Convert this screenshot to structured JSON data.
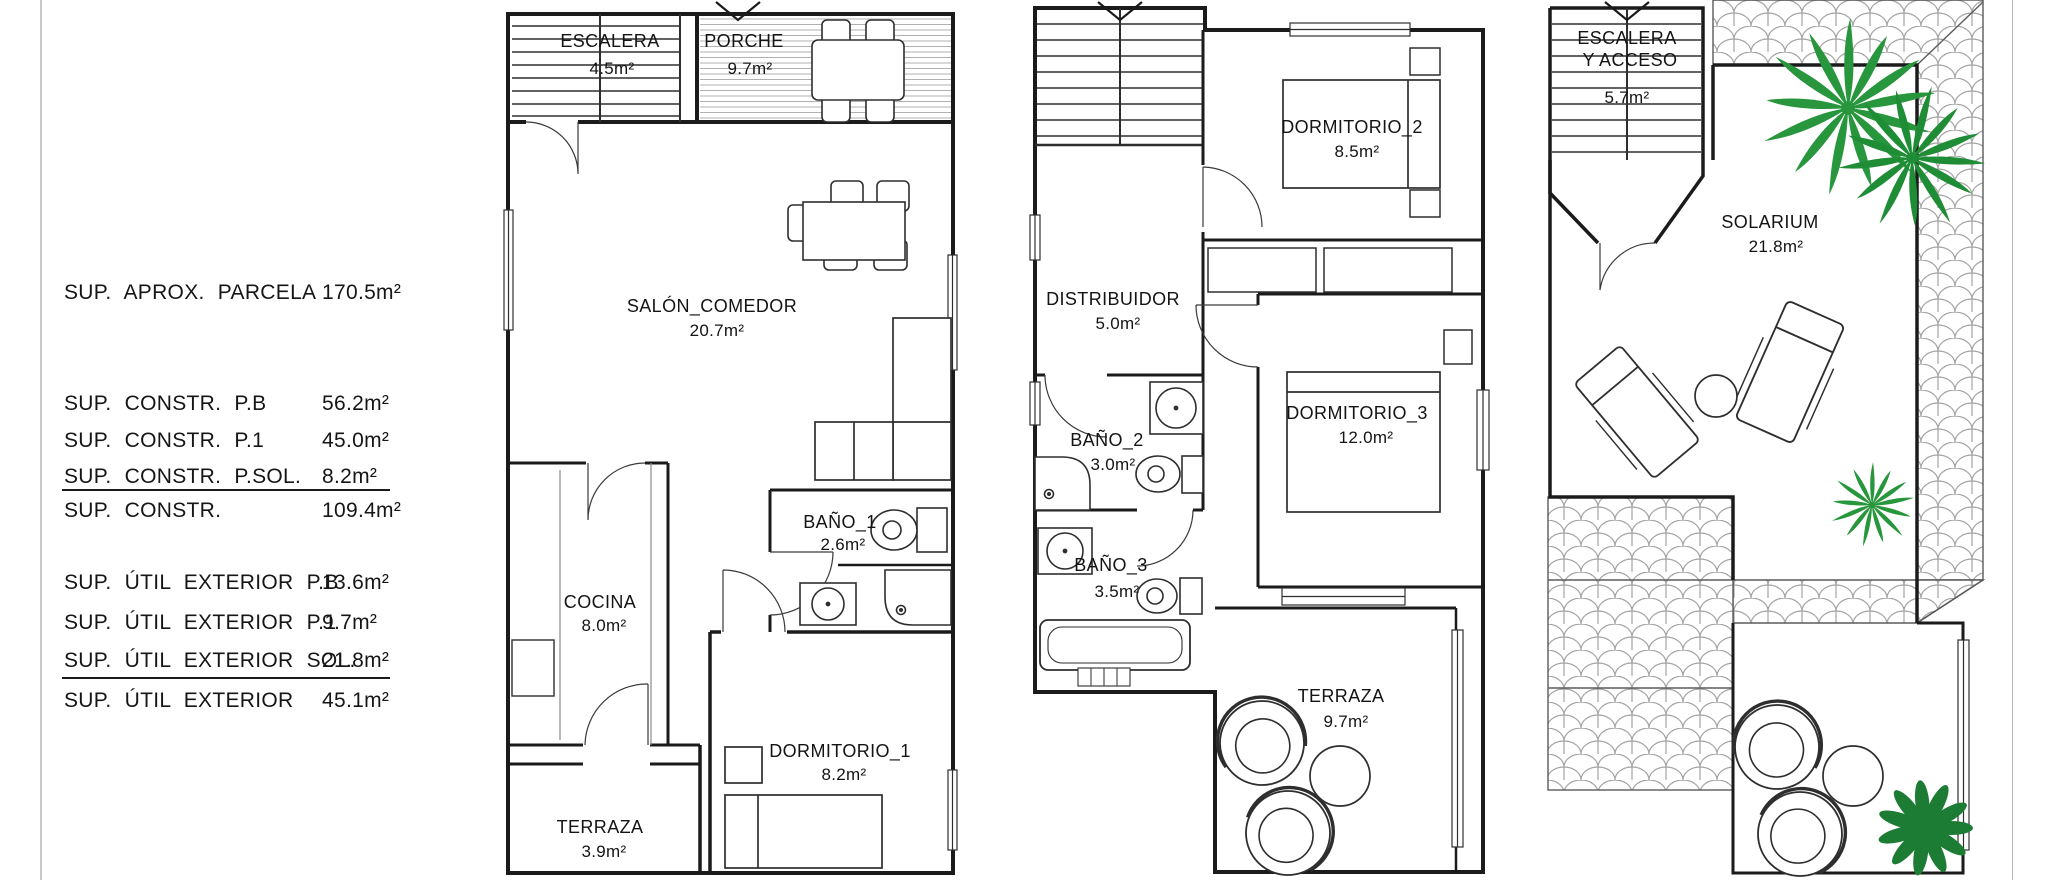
{
  "summary": {
    "rows": [
      {
        "label": "SUP. APROX. PARCELA",
        "value": "170.5m²"
      },
      {
        "label": "SUP. CONSTR. P.B",
        "value": "56.2m²"
      },
      {
        "label": "SUP. CONSTR. P.1",
        "value": "45.0m²"
      },
      {
        "label": "SUP. CONSTR. P.SOL.",
        "value": "8.2m²"
      },
      {
        "label": "SUP. CONSTR.",
        "value": "109.4m²"
      },
      {
        "label": "SUP. ÚTIL EXTERIOR P.B",
        "value": "13.6m²"
      },
      {
        "label": "SUP. ÚTIL EXTERIOR P.1",
        "value": "9.7m²"
      },
      {
        "label": "SUP. ÚTIL EXTERIOR SOL.",
        "value": "21.8m²"
      },
      {
        "label": "SUP. ÚTIL EXTERIOR",
        "value": "45.1m²"
      }
    ]
  },
  "plans": [
    {
      "id": "planta-baja",
      "rooms": [
        {
          "name": "ESCALERA",
          "area": "4.5m²"
        },
        {
          "name": "PORCHE",
          "area": "9.7m²"
        },
        {
          "name": "SALÓN_COMEDOR",
          "area": "20.7m²"
        },
        {
          "name": "BAÑO_1",
          "area": "2.6m²"
        },
        {
          "name": "COCINA",
          "area": "8.0m²"
        },
        {
          "name": "DORMITORIO_1",
          "area": "8.2m²"
        },
        {
          "name": "TERRAZA",
          "area": "3.9m²"
        }
      ]
    },
    {
      "id": "planta-primera",
      "rooms": [
        {
          "name": "DORMITORIO_2",
          "area": "8.5m²"
        },
        {
          "name": "DISTRIBUIDOR",
          "area": "5.0m²"
        },
        {
          "name": "BAÑO_2",
          "area": "3.0m²"
        },
        {
          "name": "DORMITORIO_3",
          "area": "12.0m²"
        },
        {
          "name": "BAÑO_3",
          "area": "3.5m²"
        },
        {
          "name": "TERRAZA",
          "area": "9.7m²"
        }
      ]
    },
    {
      "id": "planta-solarium",
      "rooms": [
        {
          "name_line1": "ESCALERA",
          "name_line2": "Y ACCESO",
          "area": "5.7m²"
        },
        {
          "name": "SOLARIUM",
          "area": "21.8m²"
        }
      ]
    }
  ],
  "colors": {
    "line": "#1b1b1b",
    "hatch": "#b0b0b0",
    "tile": "#a3a3a3",
    "palm_green": "#27963c",
    "plant_green": "#1d7c33"
  }
}
